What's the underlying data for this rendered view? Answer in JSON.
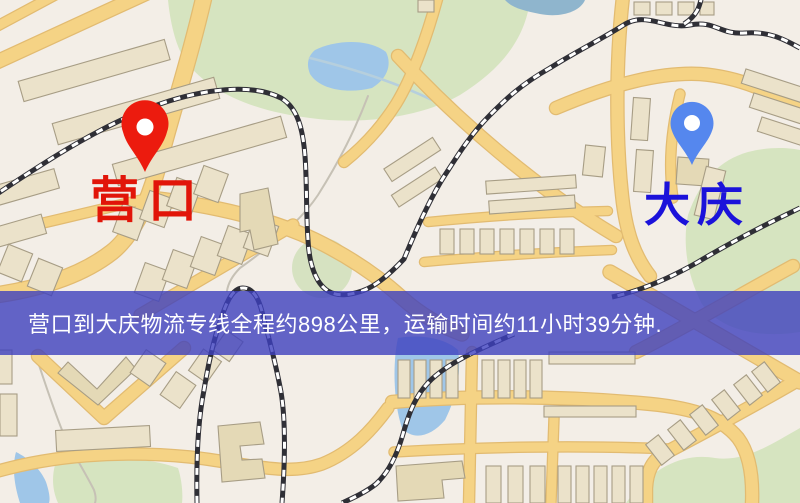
{
  "map": {
    "markers": [
      {
        "id": "origin",
        "label": "营口",
        "pin_color": "#ec1b0e",
        "label_color": "#e11509"
      },
      {
        "id": "destination",
        "label": "大庆",
        "pin_color": "#5587ee",
        "label_color": "#1b12da"
      }
    ],
    "banner": {
      "text": "营口到大庆物流专线全程约898公里，运输时间约11小时39分钟.",
      "background": "rgba(61,64,190,0.8)",
      "text_color": "#ffffff"
    },
    "colors": {
      "background": "#f3eee7",
      "park": "#d6e4c0",
      "park_dark": "#c9ddb1",
      "water": "#9fc6e8",
      "water_dark": "#8fb5cd",
      "road_fill": "#f5d385",
      "road_casing": "#e2bb71",
      "building_fill": "#ebe2ca",
      "building_stroke": "#a79d85",
      "railway_dark": "#2f2f36",
      "railway_light": "#ffffff",
      "stream": "#c6c1b5",
      "stream_blue": "#b6cfdd"
    }
  }
}
